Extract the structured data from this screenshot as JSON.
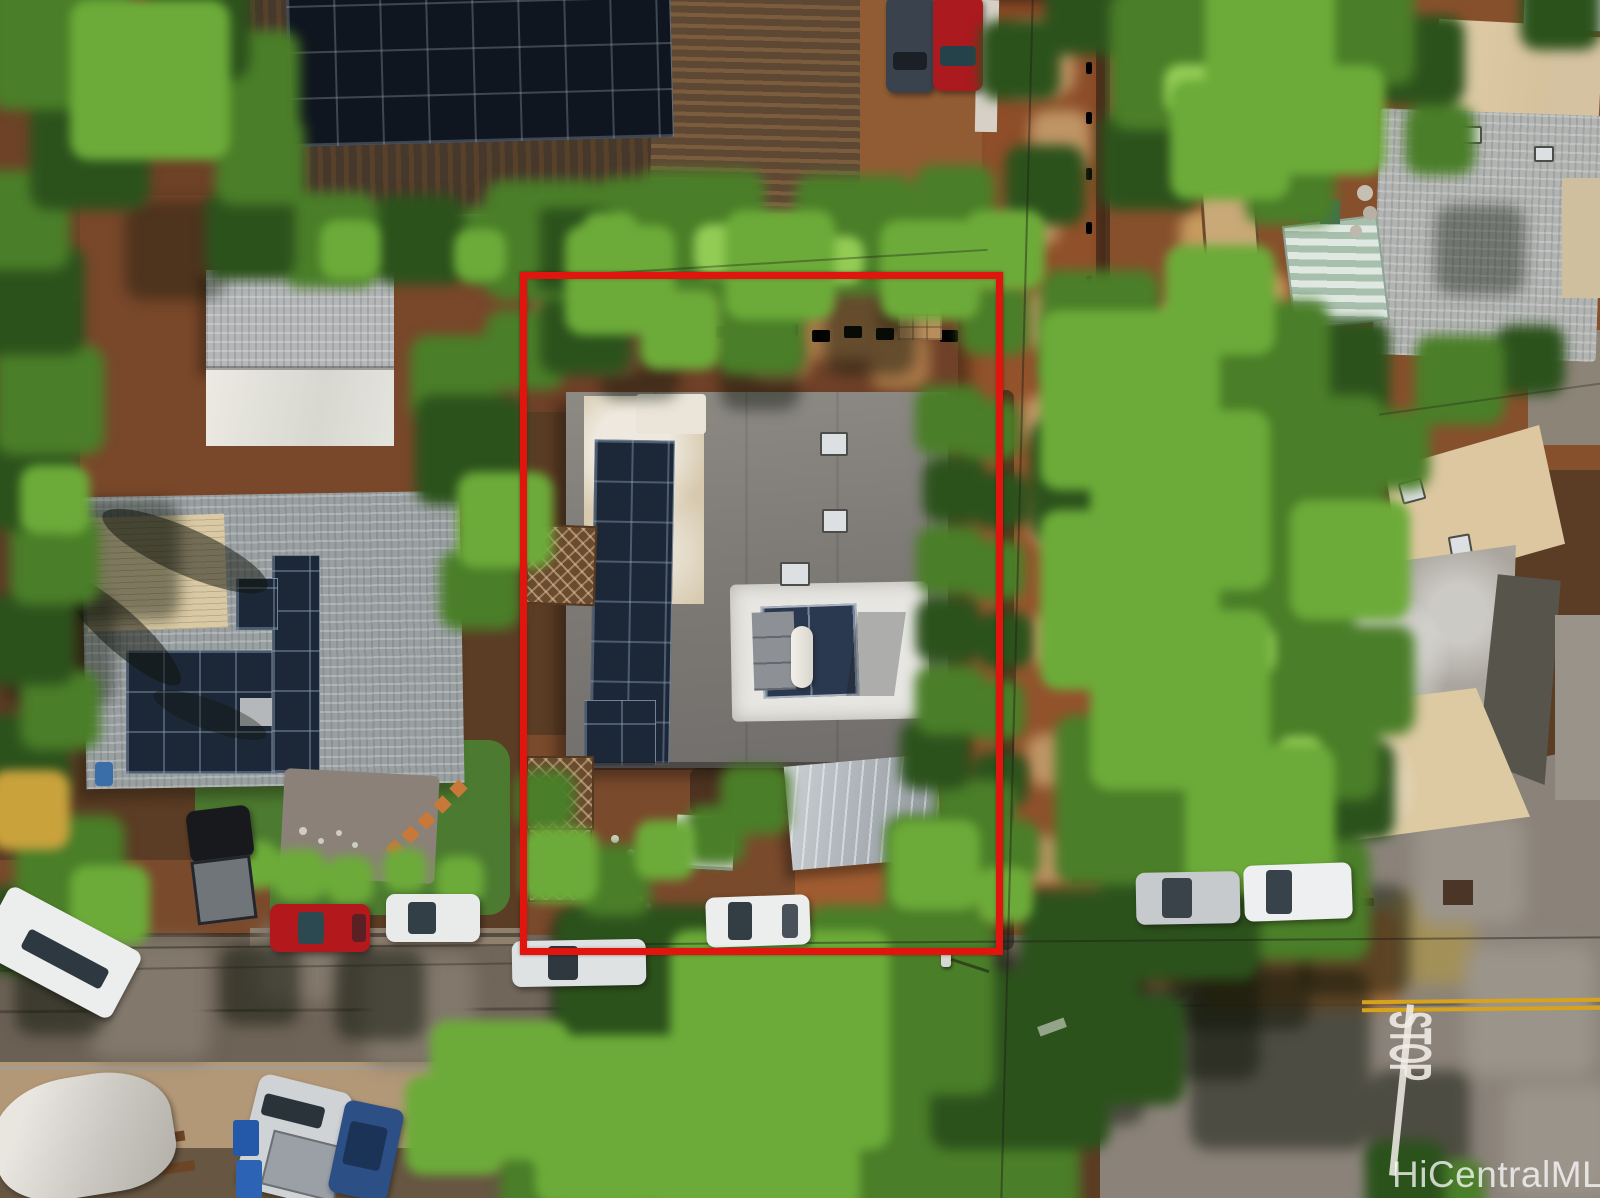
{
  "scene": {
    "type": "aerial-photograph",
    "description": "Overhead drone view of a residential lot outlined in red, Hawaii MLS listing photo",
    "watermark_text": "HiCentralMLS",
    "stop_marking_text": "STOP"
  },
  "colors": {
    "boundary-red": "#e2150e",
    "marking-white": "#f2efe8",
    "centerline-yellow": "#d7a31c",
    "watermark-white": "#ffffff",
    "solar-panel-blue": "#1c2838",
    "asphalt-gray": "#6e645a",
    "dirt-red-brown": "#8a4c28",
    "foliage-green": "#4a7e28",
    "roof-gray": "#86837e",
    "roof-tan": "#d8c8a8"
  }
}
